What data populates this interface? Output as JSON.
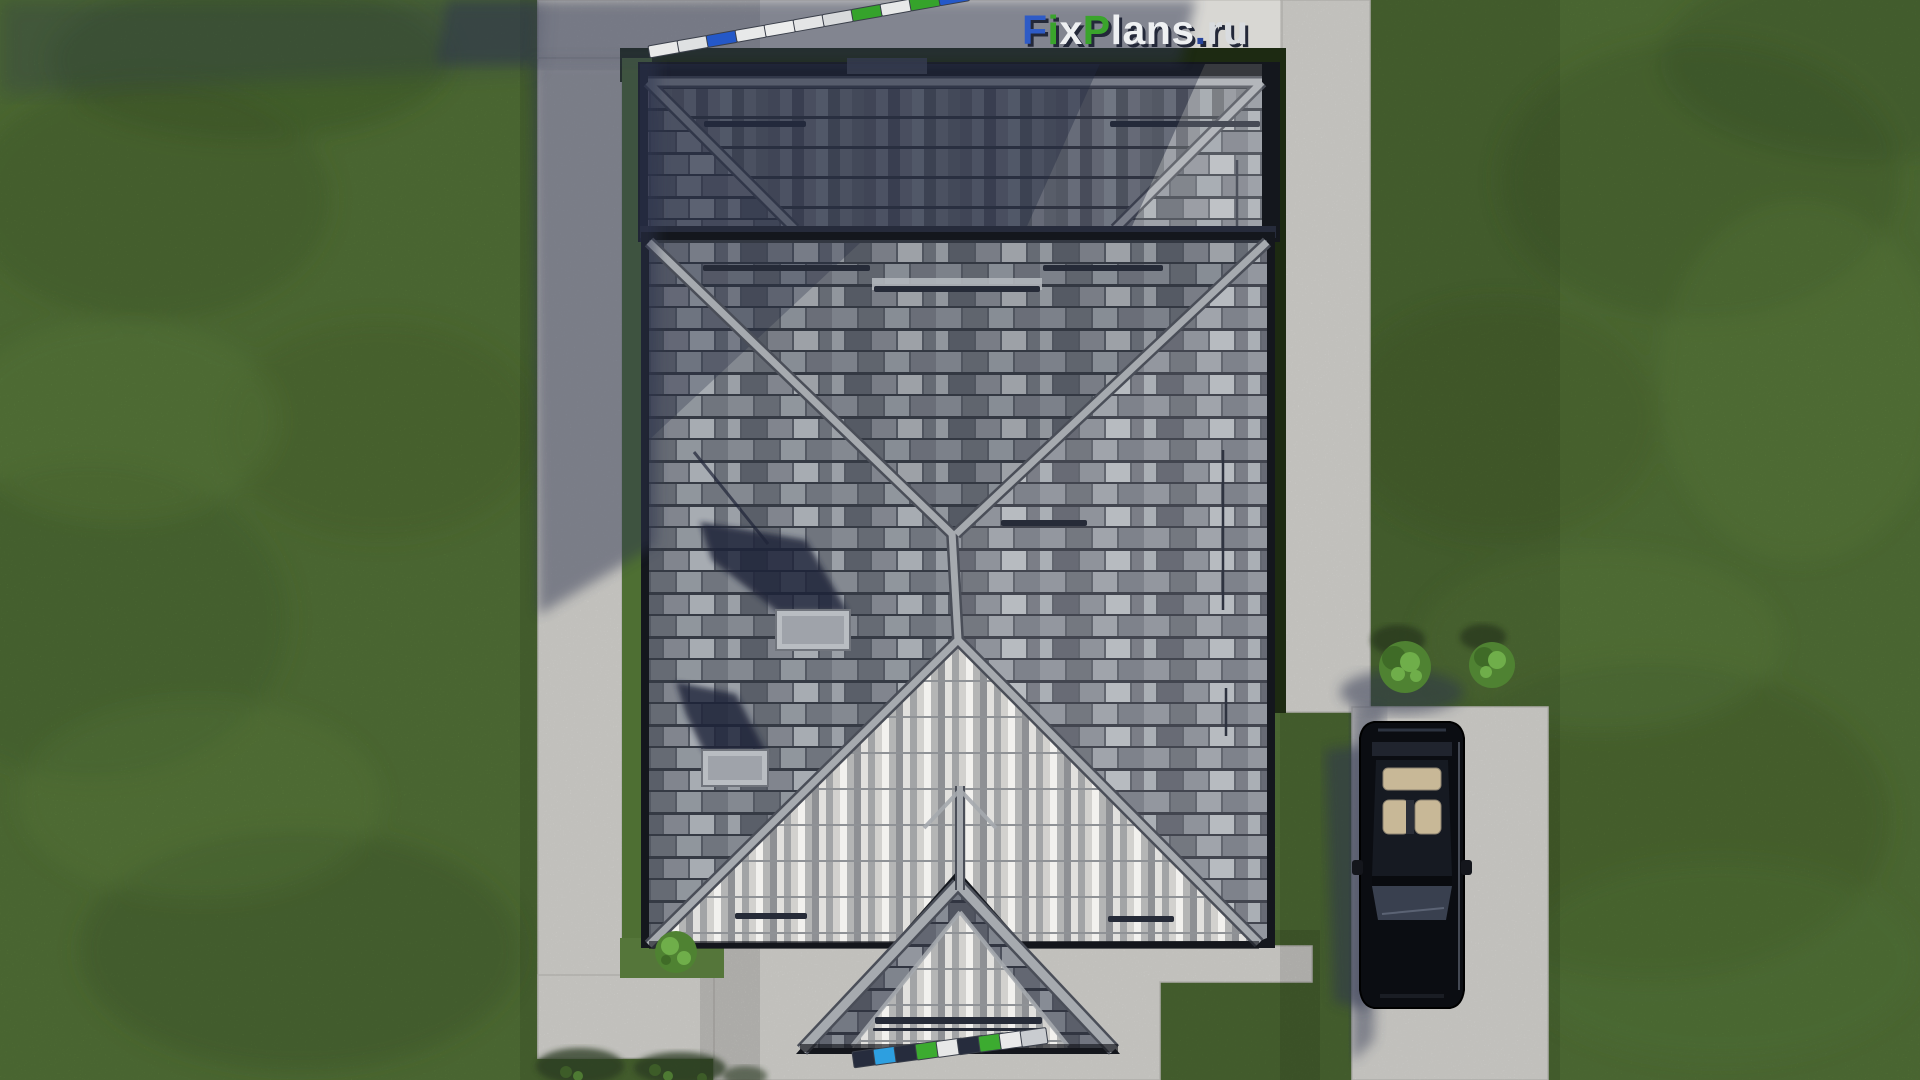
{
  "watermark": {
    "text": "FixPlans.ru",
    "shadow_color": "#232839",
    "parts": [
      {
        "text": "F",
        "color": "#2e5bc6"
      },
      {
        "text": "i",
        "color": "#3aa42c"
      },
      {
        "text": "x",
        "color": "#eef0f2"
      },
      {
        "text": "P",
        "color": "#3aa42c"
      },
      {
        "text": "lans",
        "color": "#eef0f2"
      },
      {
        "text": ".",
        "color": "#27449c"
      },
      {
        "text": "ru",
        "color": "#d9dce0"
      }
    ]
  },
  "colors": {
    "grass": "#5a7c3c",
    "grass_dark": "#4b6a30",
    "grass_light": "#6b9247",
    "concrete": "#d8d7d3",
    "shadow": "#2e3550",
    "hedge": "#1d2a12",
    "roof_silhouette": "#14171d",
    "roof_ridge": "#a6aaaf",
    "roof_ridge_edge": "#4a4e58",
    "roof_fascia": "#22252d",
    "snow_guard": "#262b38",
    "chimney": "#b9bdc2",
    "car_body": "#0b0d12",
    "car_glass": "#161a22",
    "car_seats": "#c8b897",
    "bush": "#4f8232",
    "bush_light": "#6fae4a",
    "shadow_blob": "#2c3b22"
  },
  "fences": {
    "top": {
      "x": 648,
      "y": 46,
      "step_x": 29,
      "step_y": -5.2,
      "w": 30,
      "h": 12,
      "angle": -10,
      "colors": [
        "#e8e9e9",
        "#dfe1e2",
        "#2458c8",
        "#e8e9e9",
        "#eceded",
        "#e4e5e6",
        "#d8dadc",
        "#35a32b",
        "#e8e9e9",
        "#35a32b",
        "#2458c8"
      ]
    },
    "bottom": {
      "x": 852,
      "y": 1052,
      "step_x": 21,
      "step_y": -2.6,
      "w": 26,
      "h": 16,
      "angle": -8,
      "colors": [
        "#262c3d",
        "#2d9fe0",
        "#262c3d",
        "#3cab30",
        "#e7e8e8",
        "#262c3d",
        "#3cab30",
        "#e9e9e9",
        "#c9ccd0"
      ]
    }
  }
}
